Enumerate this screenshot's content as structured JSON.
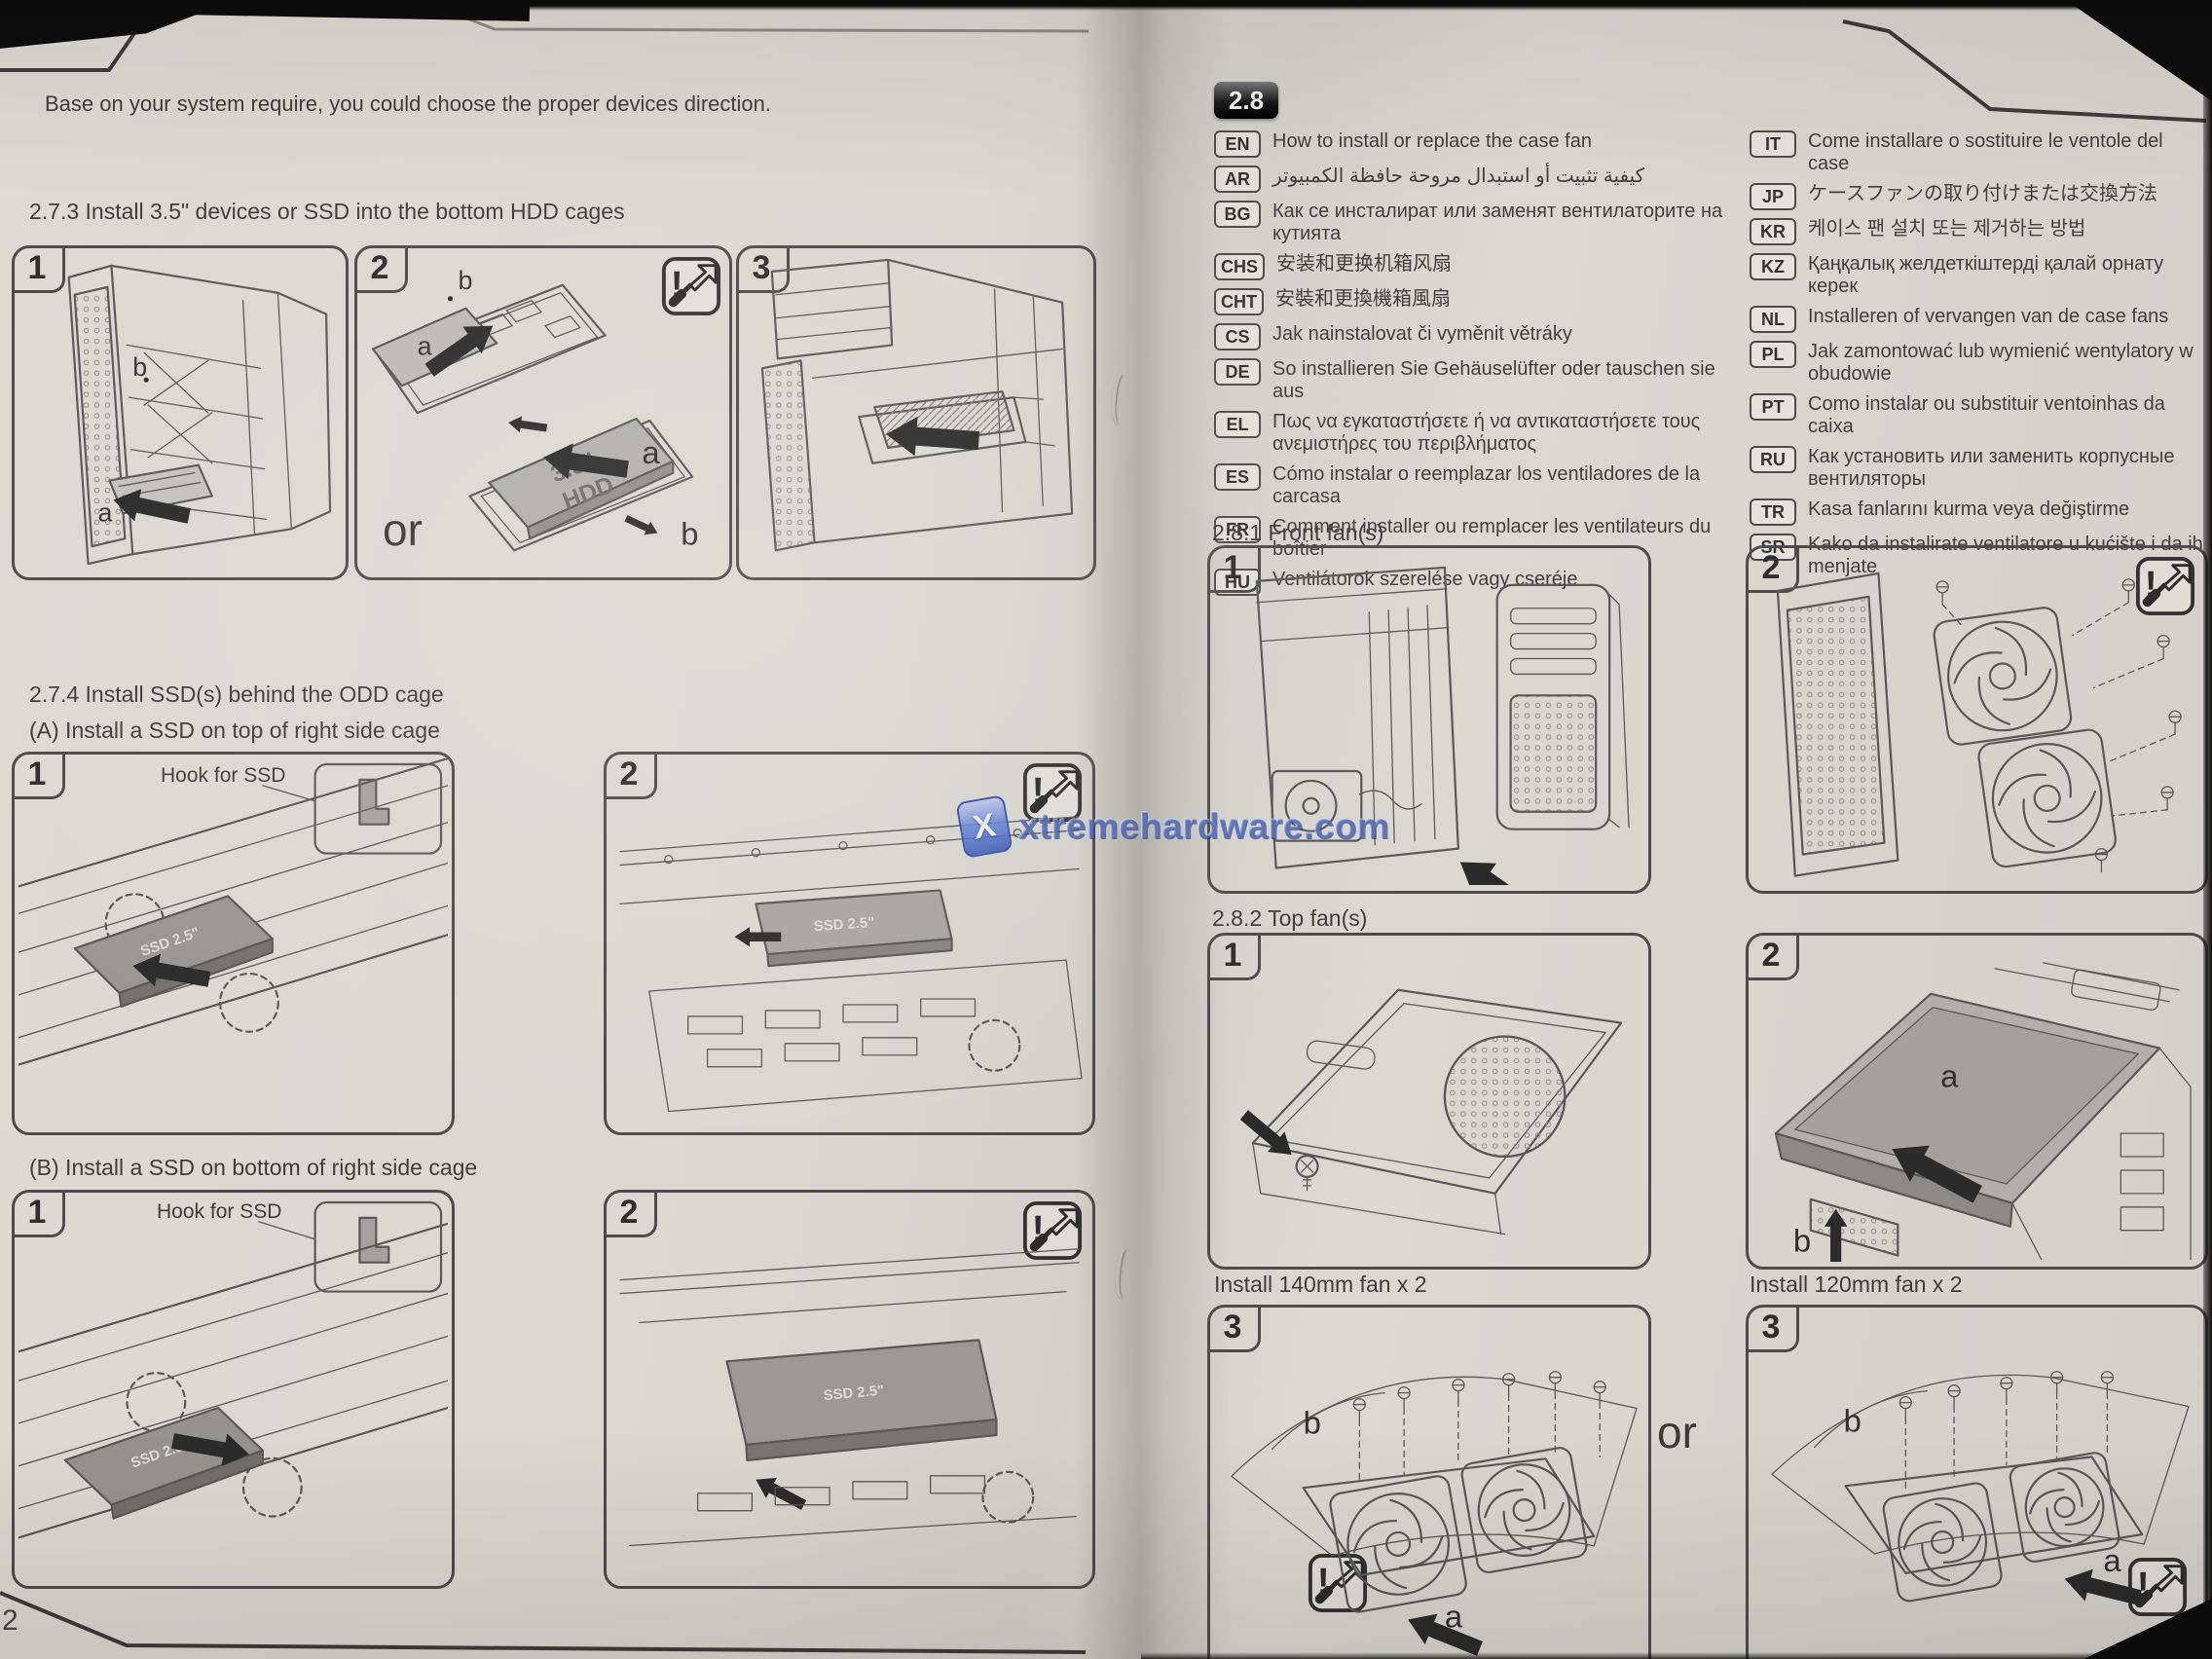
{
  "photo": {
    "page_number": "2"
  },
  "watermark": {
    "text": "xtremehardware.com"
  },
  "icons": {
    "warning_mark": "!"
  },
  "left_page": {
    "intro": "Base on your system require, you could choose the proper devices direction.",
    "s273": {
      "heading": "2.7.3 Install 3.5\" devices  or SSD into the bottom HDD cages",
      "panel1_num": "1",
      "panel2_num": "2",
      "panel3_num": "3",
      "label_a": "a",
      "label_b": "b",
      "or": "or",
      "drive_35": "3.5\"",
      "drive_hdd": "HDD"
    },
    "s274": {
      "heading": "2.7.4 Install SSD(s) behind the ODD cage",
      "sub_a": "(A) Install a SSD on top of right side cage",
      "sub_b": "(B) Install a SSD on bottom of right side cage",
      "hook_label": "Hook for SSD",
      "ssd_label": "SSD 2.5\"",
      "panel1_num": "1",
      "panel2_num": "2"
    }
  },
  "right_page": {
    "section_badge": "2.8",
    "languages_left": [
      {
        "code": "EN",
        "text": "How to install or replace the case fan"
      },
      {
        "code": "AR",
        "text": "كيفية تثبيت أو استبدال مروحة حافظة الكمبيوتر"
      },
      {
        "code": "BG",
        "text": "Как се инсталират или заменят вентилаторите на кутията"
      },
      {
        "code": "CHS",
        "text": "安装和更换机箱风扇"
      },
      {
        "code": "CHT",
        "text": "安裝和更換機箱風扇"
      },
      {
        "code": "CS",
        "text": "Jak nainstalovat či vyměnit větráky"
      },
      {
        "code": "DE",
        "text": "So installieren Sie Gehäuselüfter oder tauschen sie aus"
      },
      {
        "code": "EL",
        "text": "Πως να εγκαταστήσετε ή να αντικαταστήσετε τους ανεμιστήρες του περιβλήματος"
      },
      {
        "code": "ES",
        "text": "Cómo instalar o reemplazar los ventiladores de la carcasa"
      },
      {
        "code": "FR",
        "text": "Comment installer ou remplacer les ventilateurs du boîtier"
      },
      {
        "code": "HU",
        "text": "Ventilátorok szerelése vagy cseréje"
      }
    ],
    "languages_right": [
      {
        "code": "IT",
        "text": "Come installare o sostituire le ventole del case"
      },
      {
        "code": "JP",
        "text": "ケースファンの取り付けまたは交換方法"
      },
      {
        "code": "KR",
        "text": "케이스 팬 설치 또는 제거하는 방법"
      },
      {
        "code": "KZ",
        "text": "Қаңқалық желдеткіштерді қалай орнату керек"
      },
      {
        "code": "NL",
        "text": "Installeren of vervangen van de case fans"
      },
      {
        "code": "PL",
        "text": "Jak zamontować lub wymienić wentylatory w obudowie"
      },
      {
        "code": "PT",
        "text": "Como instalar ou substituir ventoinhas da caixa"
      },
      {
        "code": "RU",
        "text": "Как установить или заменить корпусные вентиляторы"
      },
      {
        "code": "TR",
        "text": "Kasa fanlarını kurma veya değiştirme"
      },
      {
        "code": "SR",
        "text": "Kako da instalirate ventilatore u kućište i da ih menjate"
      }
    ],
    "s281": {
      "heading": "2.8.1 Front fan(s)",
      "panel1_num": "1",
      "panel2_num": "2"
    },
    "s282": {
      "heading": "2.8.2 Top fan(s)",
      "panel1_num": "1",
      "panel2_num": "2",
      "label_a": "a",
      "label_b": "b"
    },
    "bottom": {
      "left_caption": "Install 140mm fan x 2",
      "right_caption": "Install 120mm fan x 2",
      "or": "or",
      "panel_num": "3",
      "label_a": "a",
      "label_b": "b"
    }
  }
}
